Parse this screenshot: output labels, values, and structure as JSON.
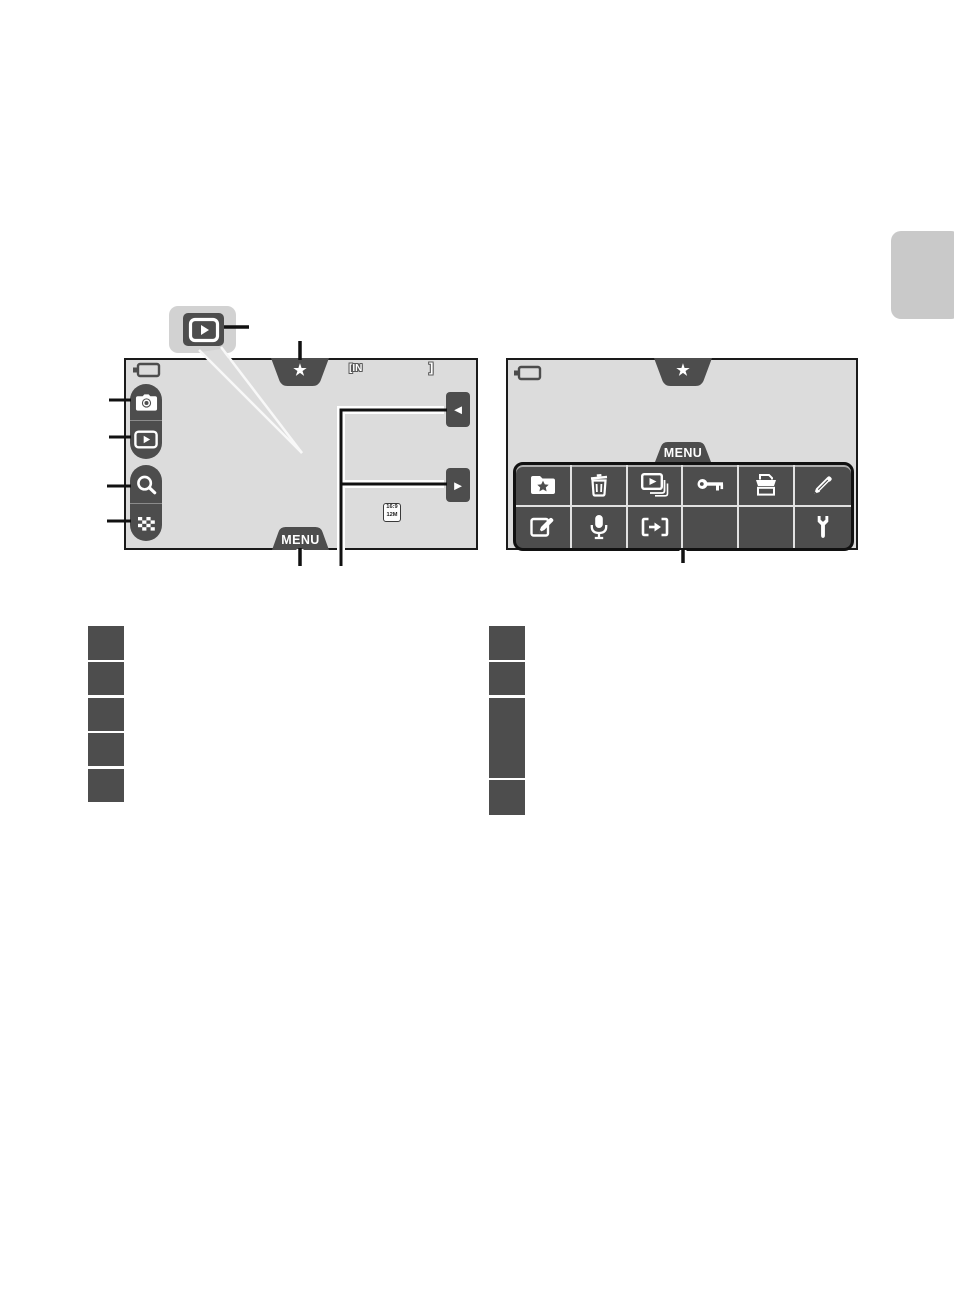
{
  "colors": {
    "dark_button": "#4d4d4d",
    "screen_background": "#dcdcdc",
    "screen_border": "#1a1a1a",
    "page_side_tab": "#c9c9c9",
    "callout_background": "#d2d2d2",
    "icon_white": "#ffffff"
  },
  "figure1": {
    "star_glyph": "★",
    "menu_label": "MENU",
    "internal_memory_label": "[IN",
    "frame_bracket": "]",
    "image_mode_top": "16:9",
    "image_mode_bottom": "12M",
    "prev_glyph": "◄",
    "next_glyph": "►",
    "sidebar_icons": [
      "shooting-mode-camera",
      "playback-mode",
      "playback-zoom-magnifier",
      "thumbnail-display"
    ],
    "callout_icon": "playback-button"
  },
  "figure2": {
    "star_glyph": "★",
    "menu_label": "MENU",
    "menu_grid": {
      "rows": [
        [
          "favorite-pictures",
          "delete",
          "slide-show",
          "protect",
          "print-order",
          "paint"
        ],
        [
          "edit",
          "voice-memo",
          "copy",
          "",
          "",
          "setup"
        ]
      ]
    }
  },
  "legend": {
    "left_marker_count": 5,
    "right_marker_count": 4
  }
}
